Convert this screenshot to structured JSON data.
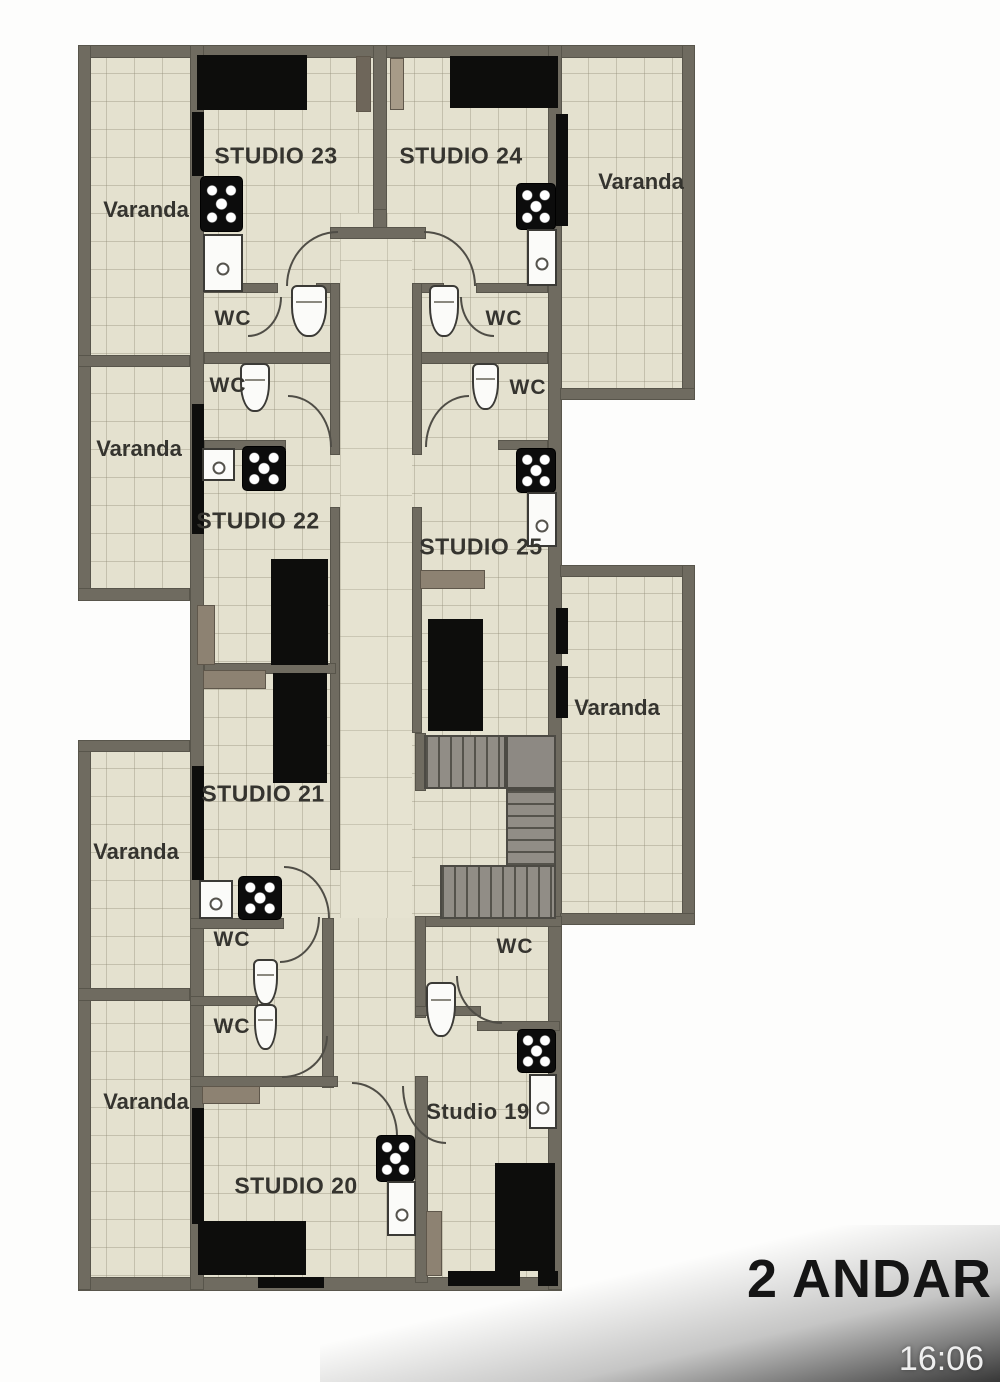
{
  "title": "2 ANDAR",
  "clock": "16:06",
  "labels": {
    "varanda": "Varanda",
    "wc": "WC"
  },
  "rooms": {
    "s19": "Studio 19",
    "s20": "STUDIO 20",
    "s21": "STUDIO 21",
    "s22": "STUDIO 22",
    "s23": "STUDIO 23",
    "s24": "STUDIO 24",
    "s25": "STUDIO 25"
  },
  "counts": {
    "varanda_labels": 6,
    "wc_labels": 7
  },
  "colors": {
    "wall": "#6f6b60",
    "floor": "#e4e1cf",
    "furniture_dark": "#0d0d0c",
    "furniture_wood": "#8d8272",
    "stairs": "#918d86",
    "fixture_white": "#fbfbf9",
    "plan_text": "#35342f",
    "title_text": "#151515",
    "clock_text": "#efefef"
  }
}
